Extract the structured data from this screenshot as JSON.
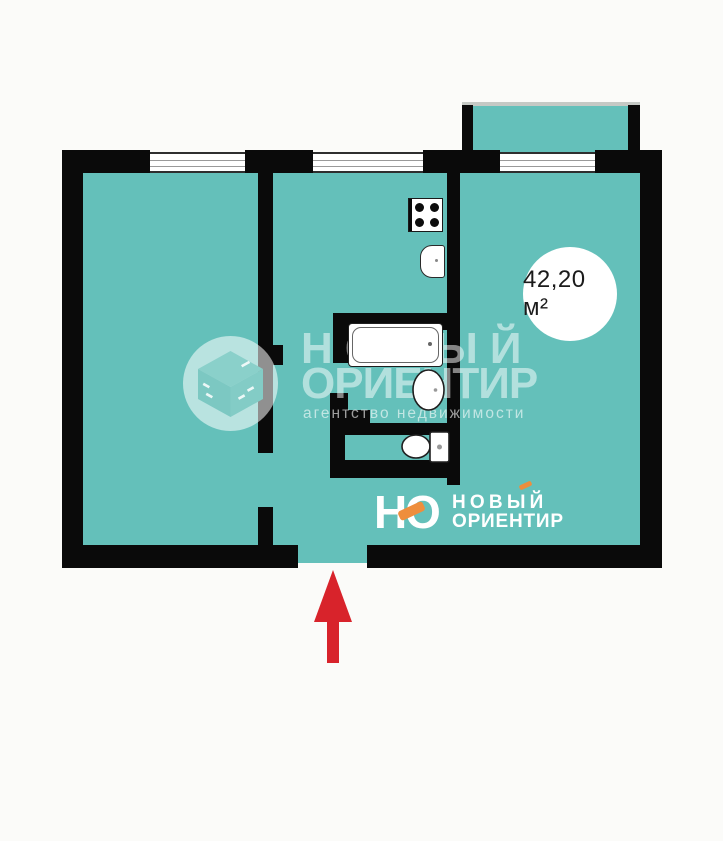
{
  "plan": {
    "area_label": "42,20 м²",
    "colors": {
      "floor_teal": "#64c0ba",
      "wall_black": "#0a0a0a",
      "window_white": "#ffffff",
      "arrow_red": "#d8232b",
      "logo_orange": "#ee8e3d",
      "background": "#fbfbf9"
    },
    "fixture_icons": [
      "stove-icon",
      "kitchen-sink-icon",
      "bathtub-icon",
      "washbasin-icon",
      "toilet-icon"
    ],
    "entrance_arrow_direction": "up"
  },
  "watermark": {
    "line1": "НОВЫЙ",
    "line2": "ОРИЕНТИР",
    "line3": "агентство недвижимости",
    "mark": "cube-in-circle-icon"
  },
  "logo": {
    "letter_n": "Н",
    "letter_o": "О",
    "name_line1": "НОВЫЙ",
    "name_line2": "ОРИЕНТИР"
  }
}
